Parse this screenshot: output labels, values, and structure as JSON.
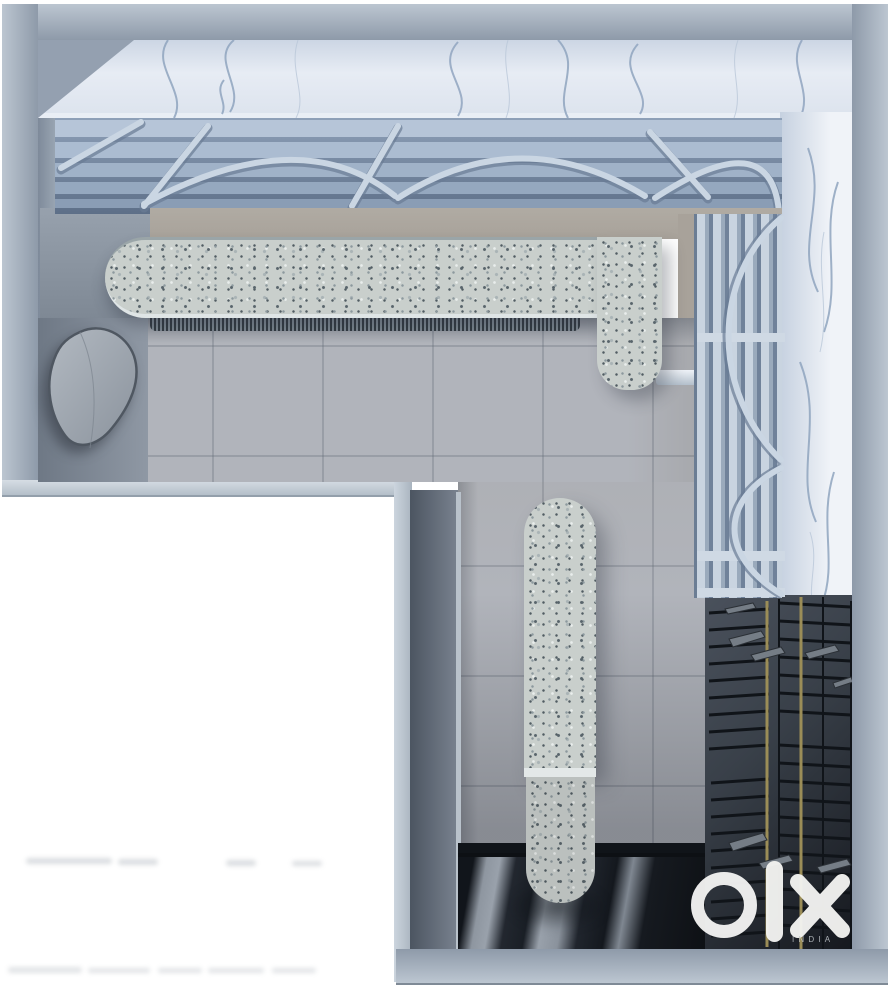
{
  "watermark": {
    "brand": "OLX",
    "country_label": "INDIA"
  },
  "palette": {
    "white": "#ffffff",
    "band_light": "#bcc6d1",
    "band_dark": "#8e9aa9",
    "marble": "#e7ecf4",
    "marble_shadow": "#c6d1e0",
    "vein": "#90a5bf",
    "slat_light": "#b6c5d8",
    "slat_dark": "#5d6f88",
    "rib": "#cad6e3",
    "tan": "#a8a29a",
    "terrazzo": "#c9cfcc",
    "speck_dark": "#59656c",
    "speck_mid": "#8d999e",
    "floor": "#b1b4bb",
    "floor_dark": "#76808d",
    "wall_face": "#8a95a3",
    "corridor_wall": "#57606d",
    "glossy_light": "#99a1ab",
    "ink": "#101419",
    "rack_bg": "#394049",
    "gold": "#9b8d57",
    "shoe": "#757d86",
    "logo": "#f3f3f1",
    "logo_sub": "#ccd1d5",
    "fringe_dark": "#333a42",
    "fringe_light": "#7d8791"
  }
}
